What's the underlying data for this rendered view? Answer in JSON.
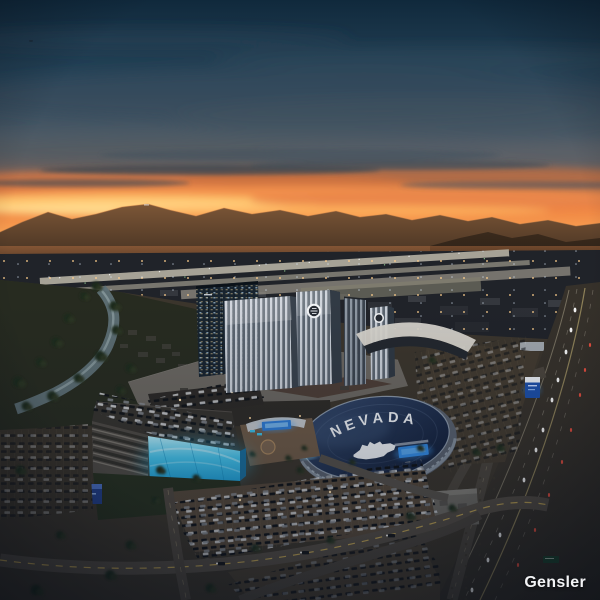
{
  "image": {
    "type": "aerial-dusk-architectural-rendering",
    "subject": "resort casino campus with hotel towers, LED parking garage and arena beside airport runway and freeway",
    "watermark": "Gensler"
  },
  "arena": {
    "roof_text": "NEVADA",
    "roof_logo": "nevada-wolf-pack-wolf-mark",
    "roof_color_top": "#35496c",
    "roof_color_bottom": "#0f1b35",
    "videoboard_color": "#2f84dc"
  },
  "resort": {
    "rooftop_badge": "circular-monogram-badge",
    "badge_color": "#f2f4f6"
  },
  "garage": {
    "led_facade_top": "#b7eefb",
    "led_facade_bottom": "#1d9dd6"
  },
  "sky": {
    "top": "#10293c",
    "upper_mid": "#27455a",
    "cloud_gray": "#4d5a66",
    "glow": "#ee8342",
    "horizon": "#ffbc62"
  },
  "highway": {
    "headlight_color": "#ffffff",
    "taillight_color": "#ff5443"
  }
}
